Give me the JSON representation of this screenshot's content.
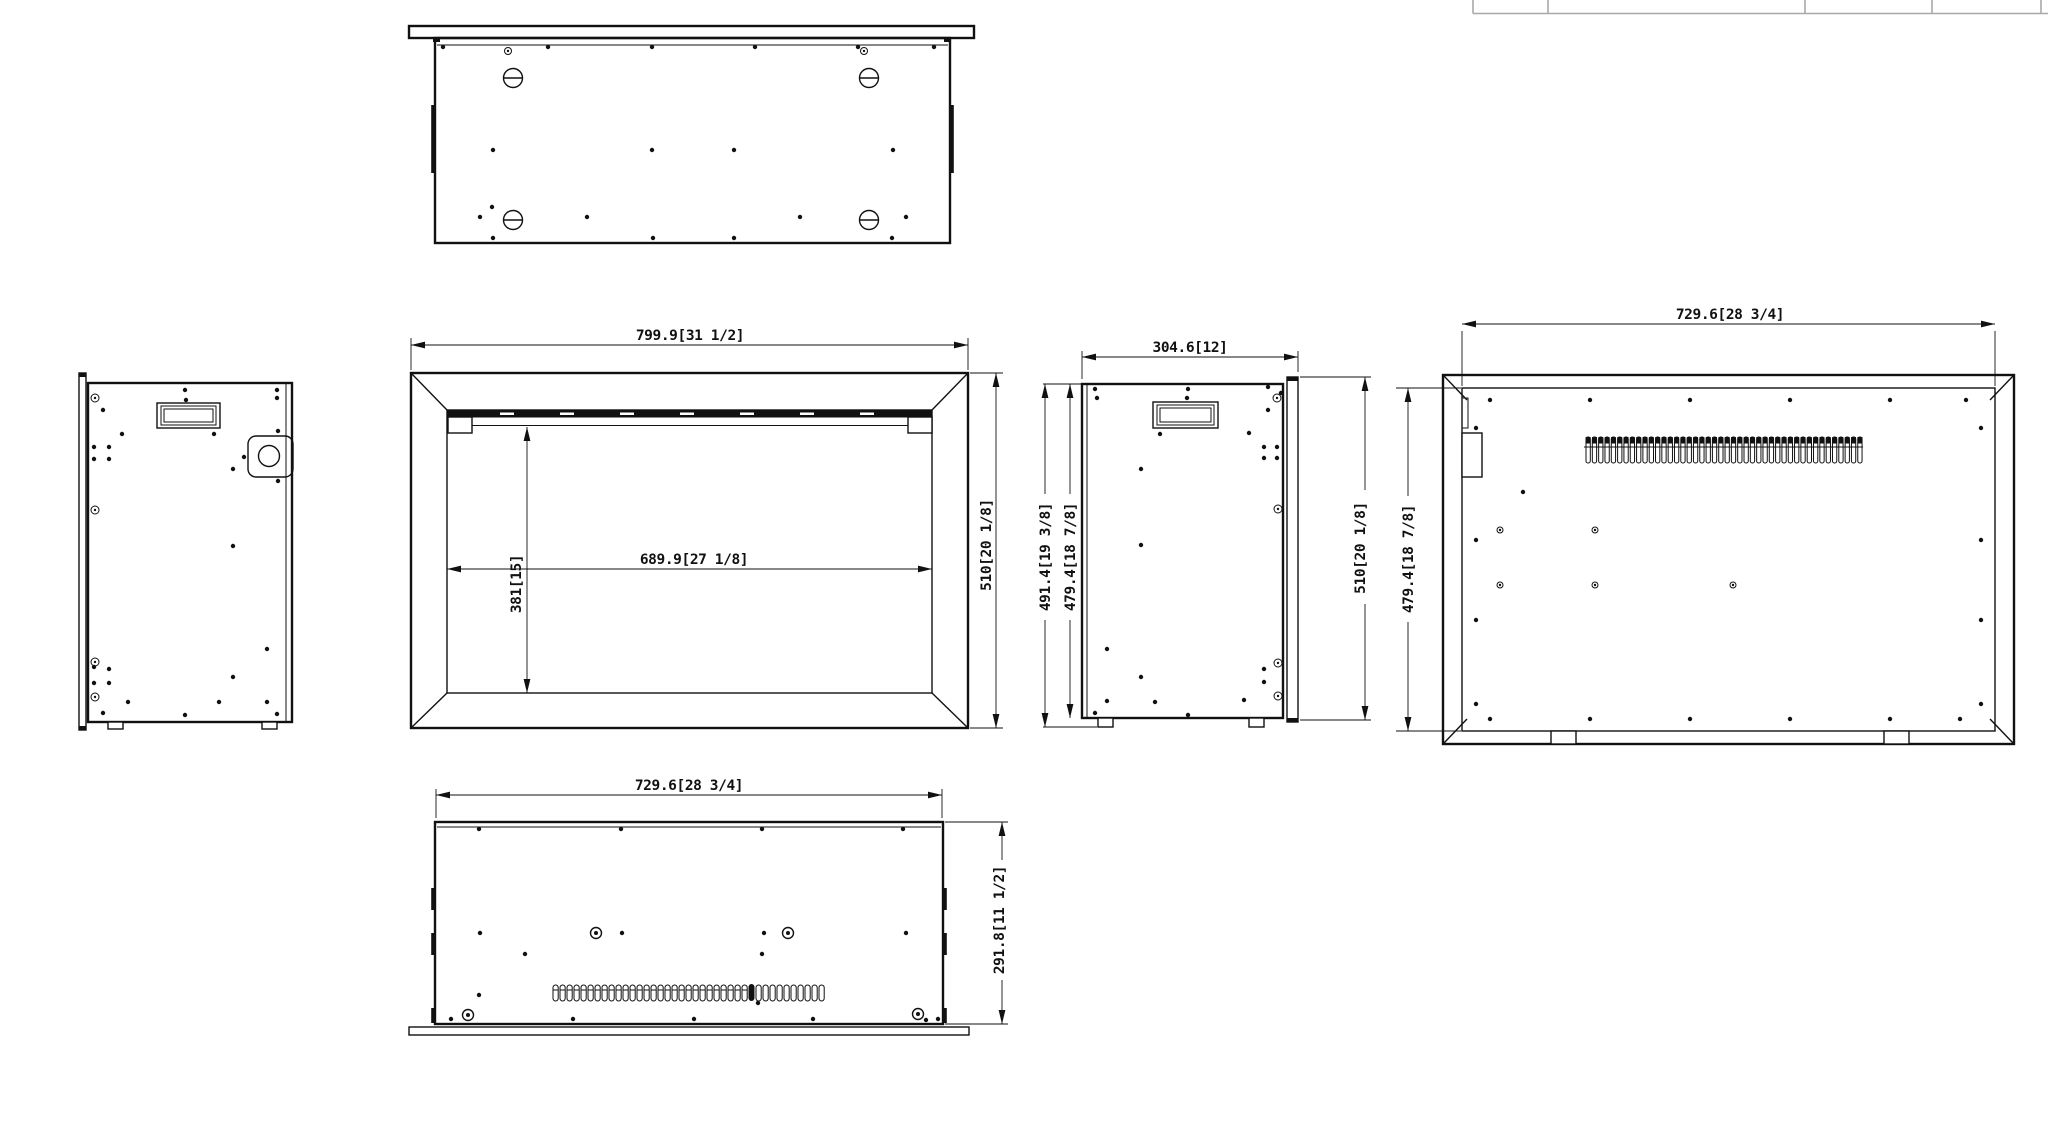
{
  "drawing": {
    "kind": "multi-view dimensional drawing of fireplace insert",
    "views": [
      "top",
      "front",
      "left-side",
      "right-side",
      "back",
      "bottom"
    ]
  },
  "dimensions": {
    "front_outer_width": "799.9[31 1/2]",
    "front_opening_width": "689.9[27 1/8]",
    "front_opening_height": "381[15]",
    "front_outer_height": "510[20 1/8]",
    "side_depth": "304.6[12]",
    "side_height_overall": "491.4[19 3/8]",
    "side_body_height": "479.4[18 7/8]",
    "side_flange_height": "510[20 1/8]",
    "back_panel_width": "729.6[28 3/4]",
    "back_panel_height": "479.4[18 7/8]",
    "bottom_body_width": "729.6[28 3/4]",
    "bottom_body_depth": "291.8[11 1/2]"
  },
  "colors": {
    "ink": "#111111",
    "paper": "#ffffff",
    "titleblock_line": "#a8a8a8"
  }
}
